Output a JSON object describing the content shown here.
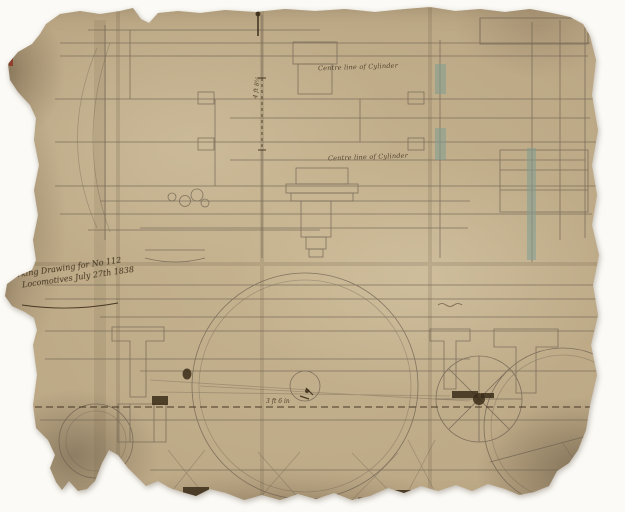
{
  "scan": {
    "background_color": "#fbfaf6"
  },
  "sheet": {
    "paper_color": "#c6b38f",
    "pencil_color": "#6e6152",
    "ink_color": "#3a2b19",
    "blue_wash_color": "#7f9e94",
    "red_mark_color": "#8d3425"
  },
  "annotations": {
    "title_line1": "Working Drawing for No 112",
    "title_line2": "Locomotives  July 27th 1838",
    "centre_line_upper": "Centre line of Cylinder",
    "centre_line_lower": "Centre line of Cylinder",
    "gauge_dimension": "4 ft 8½",
    "wheel_dimension": "3 ft 6 in"
  }
}
